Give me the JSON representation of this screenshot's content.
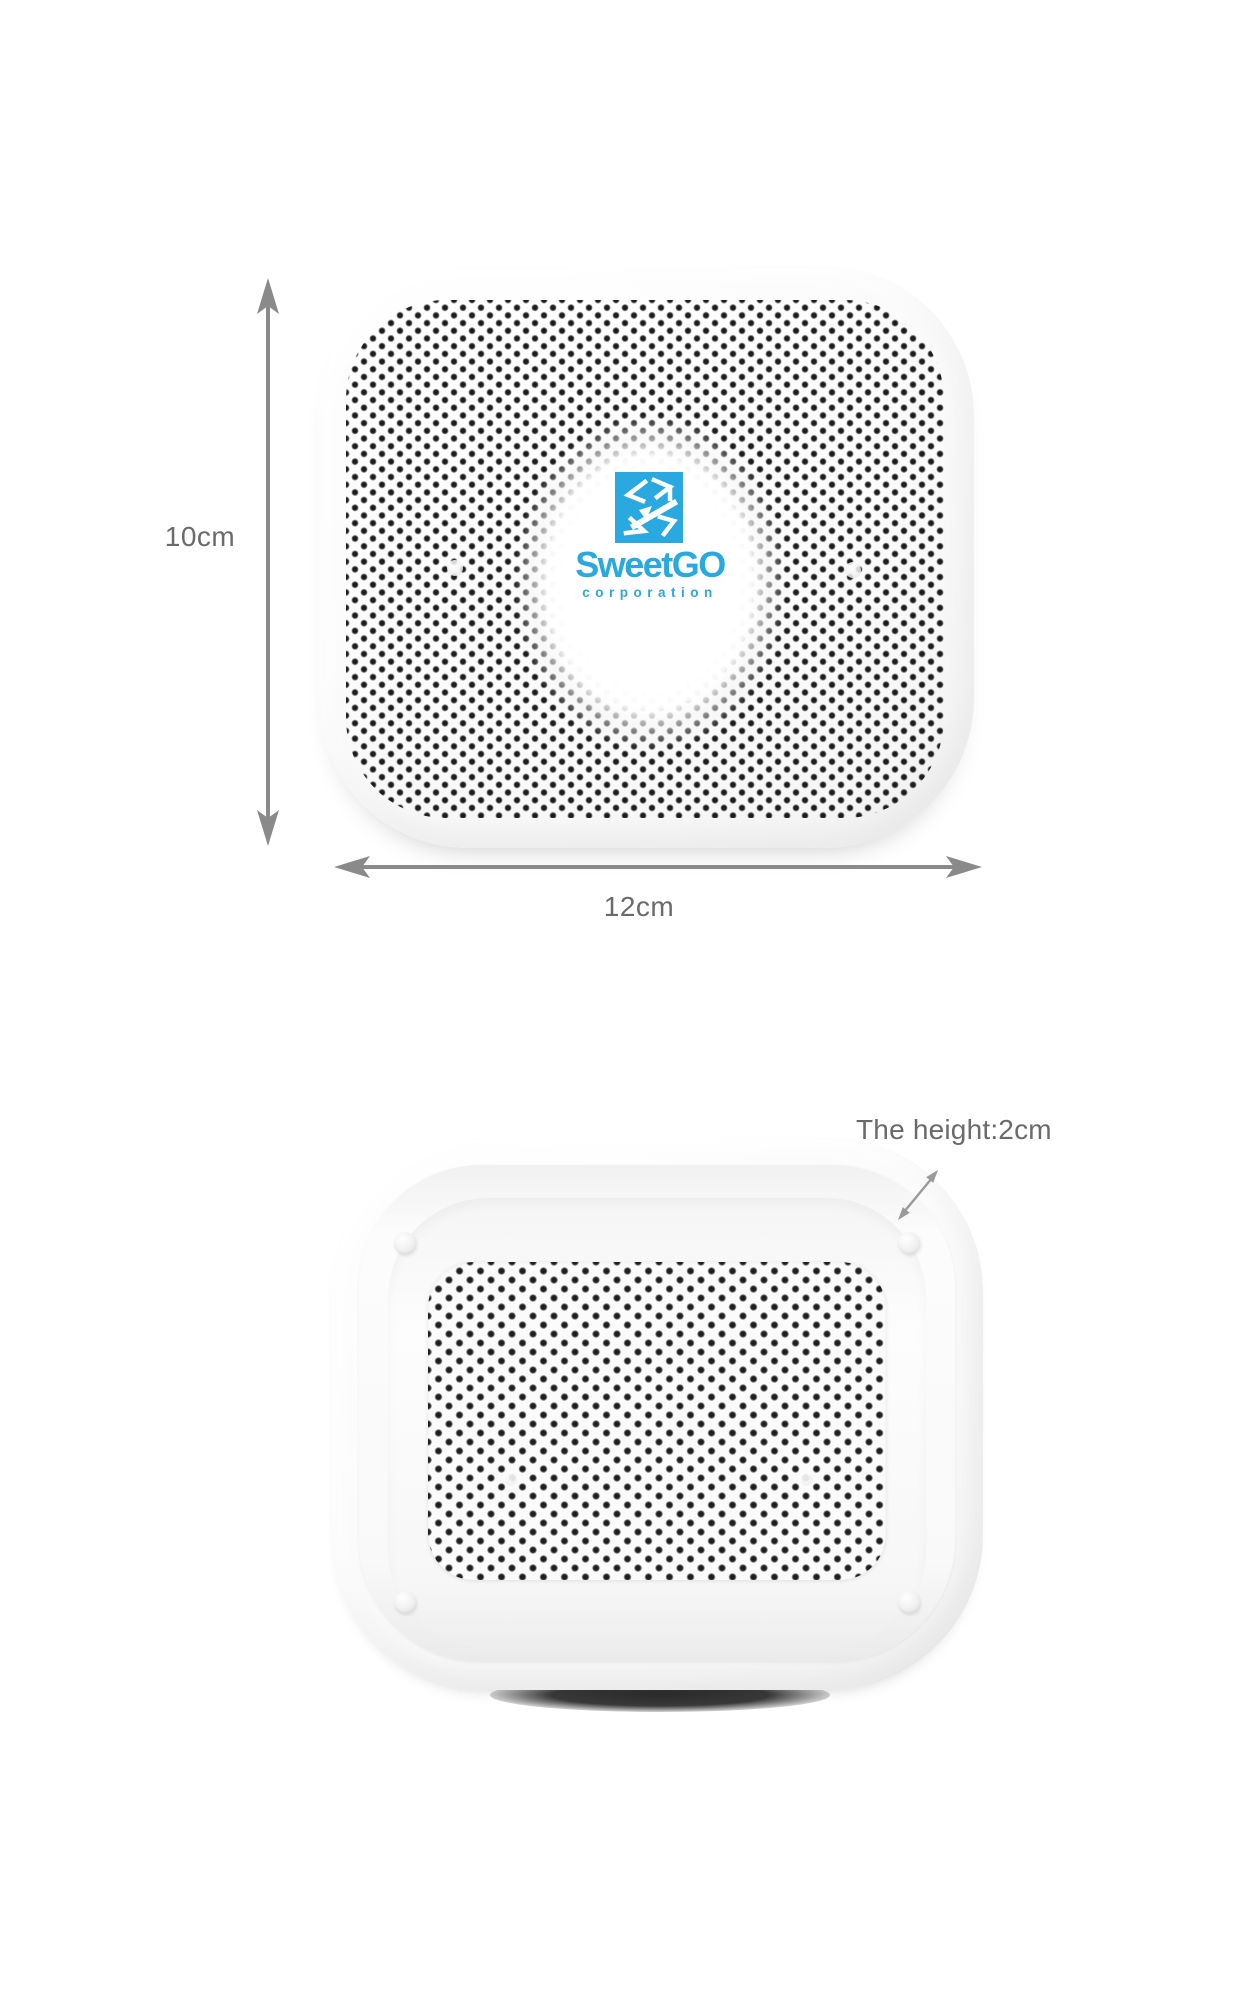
{
  "image": {
    "background": "#ffffff"
  },
  "brand": {
    "name": "SweetGO",
    "subtitle": "corporation",
    "color": "#29a9e0"
  },
  "annotations": {
    "label_color": "#6a6a6a",
    "arrow_color": "#8a8a8a",
    "front_height_label": "10cm",
    "front_width_label": "12cm",
    "back_height_label": "The height:2cm"
  },
  "product_colors": {
    "body": "#f7f7f7",
    "grille_holes": "#1d1d1d",
    "base": "#2c2c2c"
  }
}
